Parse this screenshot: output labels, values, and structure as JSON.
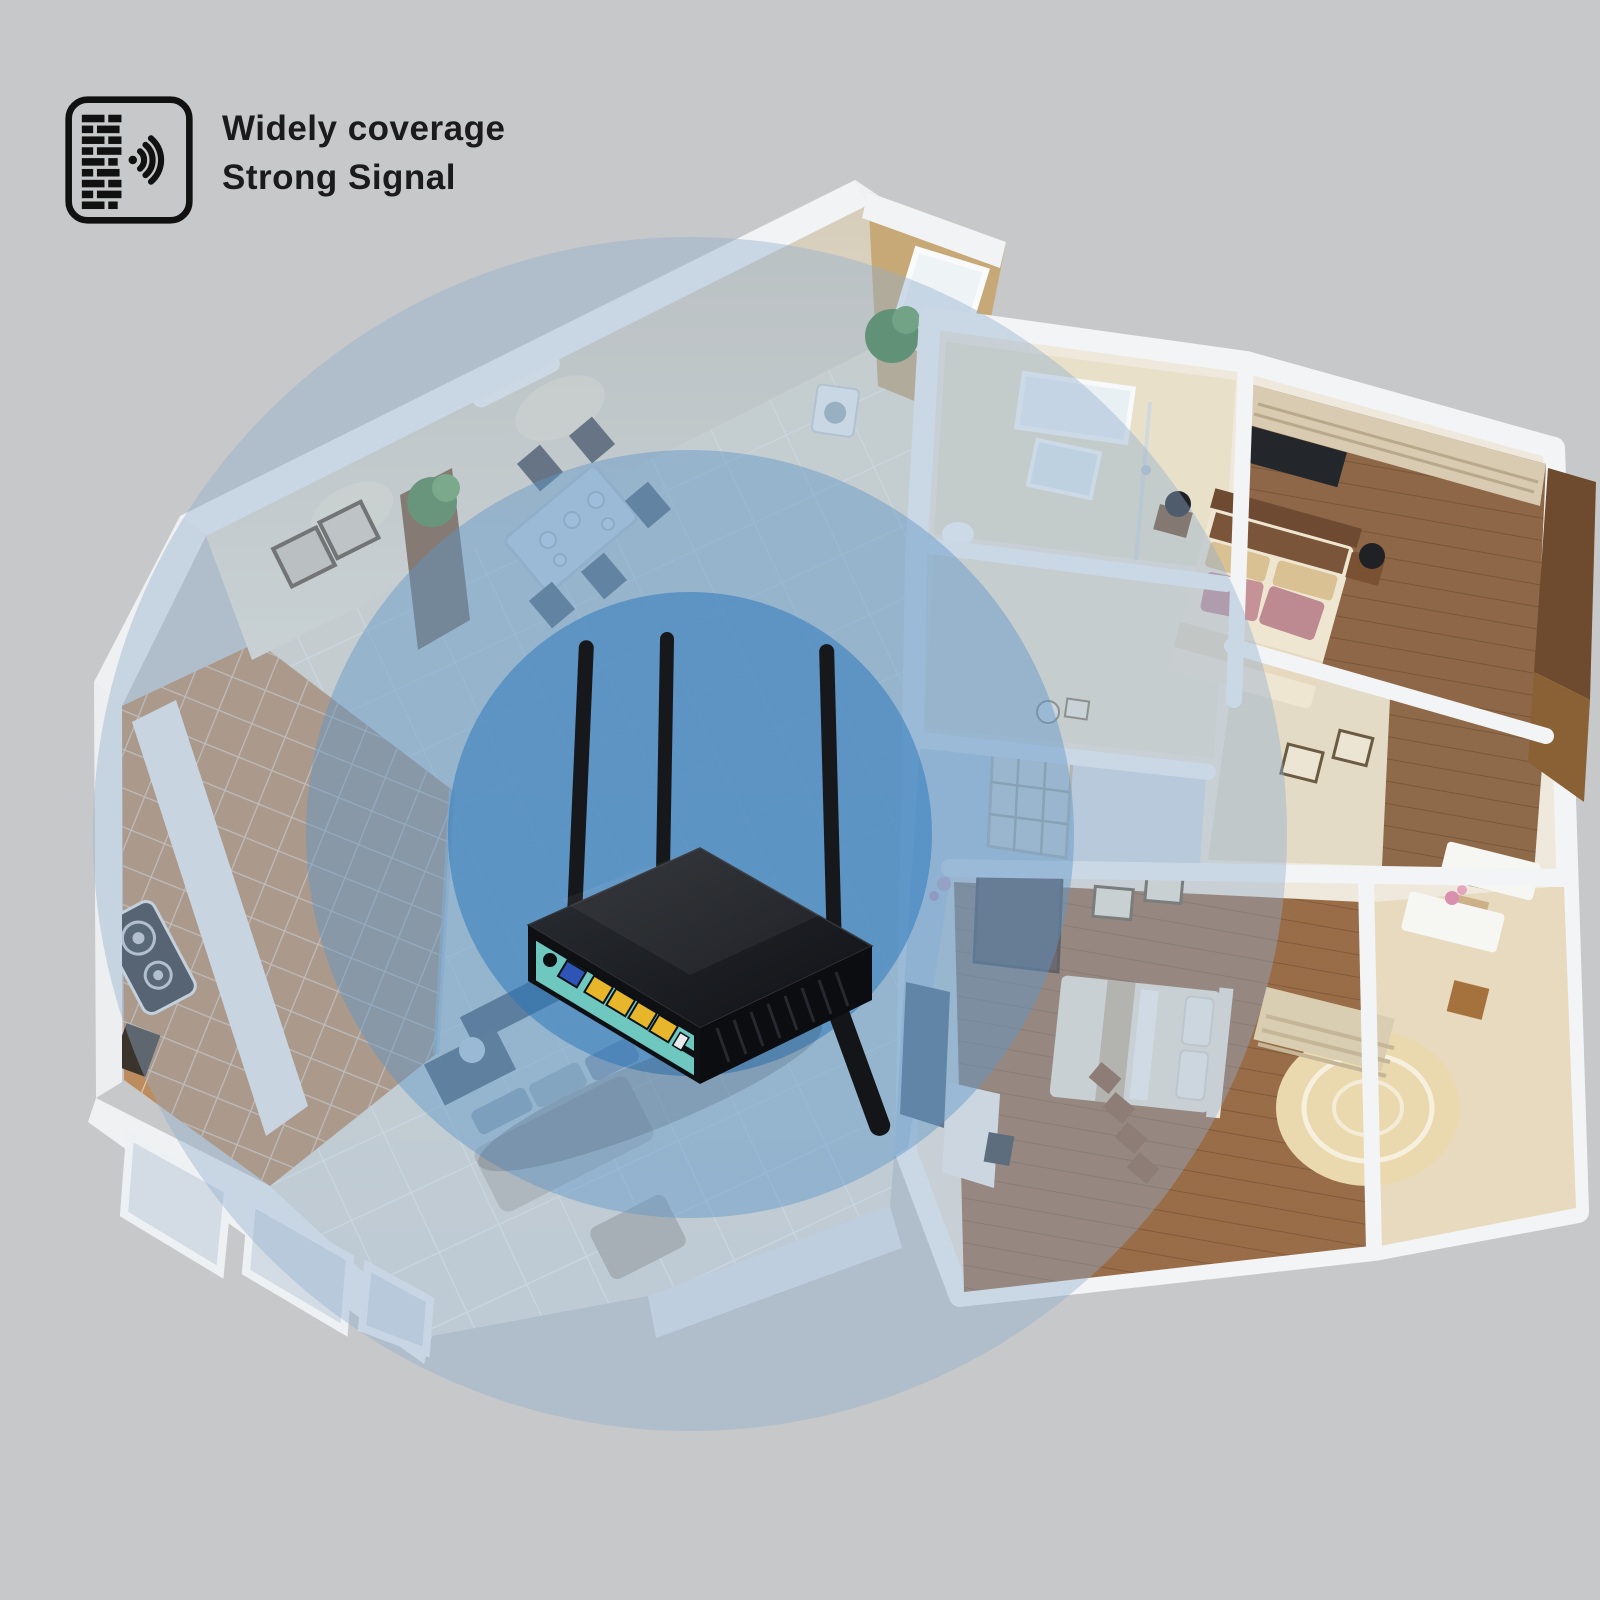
{
  "badge": {
    "icon": "wall-signal-icon",
    "line1": "Widely coverage",
    "line2": "Strong Signal",
    "text_color": "#1b1b1d"
  },
  "signal": {
    "center": {
      "x": 690,
      "y": 834
    },
    "radii": {
      "inner": 242,
      "middle": 384,
      "outer": 597
    },
    "inner_color": "rgba(35,115,185,0.50)",
    "middle_color": "rgba(95,150,200,0.45)",
    "outer_color": "rgba(145,175,205,0.42)"
  },
  "router": {
    "body_color": "#17191d",
    "panel_color": "#6fc8c0",
    "wan_port_color": "#2e55b5",
    "lan_port_color": "#e8b62a",
    "antenna_count": 4,
    "lan_port_count": 4
  }
}
